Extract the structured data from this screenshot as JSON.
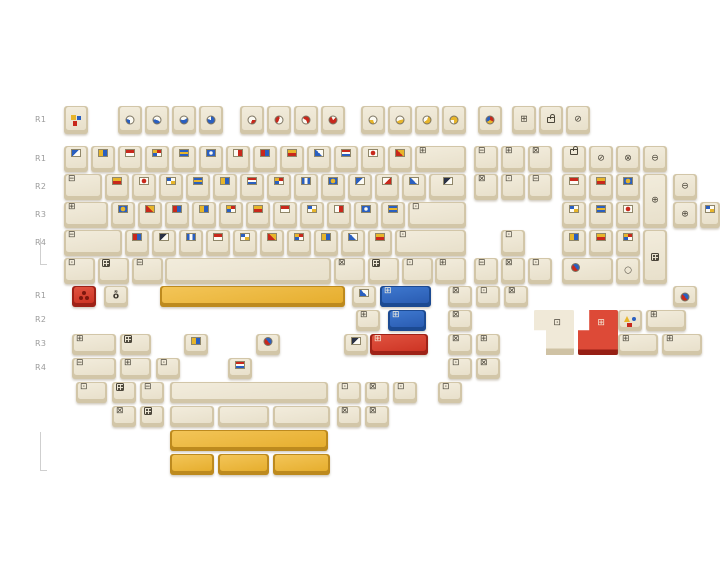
{
  "image": {
    "kind": "keycap-set-product-render",
    "background": "#ffffff"
  },
  "palette": {
    "cap_cream_top": "#ece5d3",
    "cap_cream_side": "#d2c6a8",
    "cap_yellow_top": "#eeba43",
    "cap_yellow_side": "#bd8a1e",
    "cap_red_top": "#d93b2a",
    "cap_red_side": "#9e2217",
    "cap_blue_top": "#2f6cc3",
    "cap_blue_side": "#1c4a92",
    "legend_red": "#c8281c",
    "legend_blue": "#2a5fc0",
    "legend_yellow": "#e7b52b",
    "legend_outline": "#4a4539",
    "label_gray": "#9c9c9c"
  },
  "row_labels": [
    {
      "t": "R1",
      "x": 35,
      "y": 115
    },
    {
      "t": "R1",
      "x": 35,
      "y": 154
    },
    {
      "t": "R2",
      "x": 35,
      "y": 182
    },
    {
      "t": "R3",
      "x": 35,
      "y": 210
    },
    {
      "t": "R4",
      "x": 35,
      "y": 238
    },
    {
      "t": "R1",
      "x": 35,
      "y": 291
    },
    {
      "t": "R2",
      "x": 35,
      "y": 315
    },
    {
      "t": "R3",
      "x": 35,
      "y": 339
    },
    {
      "t": "R4",
      "x": 35,
      "y": 363
    }
  ],
  "brackets": [
    {
      "x": 40,
      "y": 238,
      "w": 6,
      "h": 26
    },
    {
      "x": 40,
      "y": 432,
      "w": 6,
      "h": 38
    }
  ],
  "keys": [
    {
      "n": "key-esc",
      "x": 64,
      "y": 106,
      "t": "esc",
      "p": "c"
    },
    {
      "n": "key-f1",
      "x": 118,
      "y": 106,
      "t": "pie",
      "v": "b30-180",
      "p": "c"
    },
    {
      "n": "key-f2",
      "x": 145,
      "y": 106,
      "t": "pie",
      "v": "b45-120",
      "p": "c"
    },
    {
      "n": "key-f3",
      "x": 172,
      "y": 106,
      "t": "pie",
      "v": "b60-60",
      "p": "c"
    },
    {
      "n": "key-f4",
      "x": 199,
      "y": 106,
      "t": "pie",
      "v": "b80-0",
      "p": "c"
    },
    {
      "n": "key-f5",
      "x": 240,
      "y": 106,
      "t": "pie",
      "v": "r30-90",
      "p": "c"
    },
    {
      "n": "key-f6",
      "x": 267,
      "y": 106,
      "t": "pie",
      "v": "r45-210",
      "p": "c"
    },
    {
      "n": "key-f7",
      "x": 294,
      "y": 106,
      "t": "pie",
      "v": "r60-300",
      "p": "c"
    },
    {
      "n": "key-f8",
      "x": 321,
      "y": 106,
      "t": "pie",
      "v": "r80-45",
      "p": "c"
    },
    {
      "n": "key-f9",
      "x": 361,
      "y": 106,
      "t": "pie",
      "v": "y30-160",
      "p": "c"
    },
    {
      "n": "key-f10",
      "x": 388,
      "y": 106,
      "t": "pie",
      "v": "y45-80",
      "p": "c"
    },
    {
      "n": "key-f11",
      "x": 415,
      "y": 106,
      "t": "pie",
      "v": "y60-20",
      "p": "c"
    },
    {
      "n": "key-f12",
      "x": 442,
      "y": 106,
      "t": "pie",
      "v": "y75-270",
      "p": "c"
    },
    {
      "n": "key-novelty-pie",
      "x": 478,
      "y": 106,
      "t": "pie",
      "v": "m",
      "p": "c"
    },
    {
      "n": "key-printscreen",
      "x": 512,
      "y": 106,
      "t": "box",
      "v": "⊞",
      "p": "c"
    },
    {
      "n": "key-scrolllock",
      "x": 539,
      "y": 106,
      "t": "lock",
      "p": "c"
    },
    {
      "n": "key-pause",
      "x": 566,
      "y": 106,
      "t": "box",
      "v": "⊘",
      "p": "c"
    },
    {
      "n": "key-r1-1",
      "x": 64,
      "y": 146,
      "t": "flag",
      "v": "f1"
    },
    {
      "n": "key-r1-2",
      "x": 91,
      "y": 146,
      "t": "flag",
      "v": "f2"
    },
    {
      "n": "key-r1-3",
      "x": 118,
      "y": 146,
      "t": "flag",
      "v": "f3"
    },
    {
      "n": "key-r1-4",
      "x": 145,
      "y": 146,
      "t": "flag",
      "v": "f6"
    },
    {
      "n": "key-r1-5",
      "x": 172,
      "y": 146,
      "t": "flag",
      "v": "f5"
    },
    {
      "n": "key-r1-6",
      "x": 199,
      "y": 146,
      "t": "flag",
      "v": "f9"
    },
    {
      "n": "key-r1-7",
      "x": 226,
      "y": 146,
      "t": "flag",
      "v": "f7"
    },
    {
      "n": "key-r1-8",
      "x": 253,
      "y": 146,
      "t": "flag",
      "v": "f14"
    },
    {
      "n": "key-r1-9",
      "x": 280,
      "y": 146,
      "t": "flag",
      "v": "f8"
    },
    {
      "n": "key-r1-10",
      "x": 307,
      "y": 146,
      "t": "flag",
      "v": "f13"
    },
    {
      "n": "key-r1-11",
      "x": 334,
      "y": 146,
      "t": "flag",
      "v": "f10"
    },
    {
      "n": "key-r1-12",
      "x": 361,
      "y": 146,
      "t": "flag",
      "v": "f4"
    },
    {
      "n": "key-r1-13",
      "x": 388,
      "y": 146,
      "t": "flag",
      "v": "f11"
    },
    {
      "n": "key-backspace",
      "x": 415,
      "y": 146,
      "w": 51,
      "t": "box",
      "v": "⊞"
    },
    {
      "n": "key-tab",
      "x": 64,
      "y": 174,
      "w": 38,
      "t": "box",
      "v": "⊟"
    },
    {
      "n": "key-r2-1",
      "x": 105,
      "y": 174,
      "t": "flag",
      "v": "f8"
    },
    {
      "n": "key-r2-2",
      "x": 132,
      "y": 174,
      "t": "flag",
      "v": "f4"
    },
    {
      "n": "key-r2-3",
      "x": 159,
      "y": 174,
      "t": "flag",
      "v": "f16"
    },
    {
      "n": "key-r2-4",
      "x": 186,
      "y": 174,
      "t": "flag",
      "v": "f5"
    },
    {
      "n": "key-r2-5",
      "x": 213,
      "y": 174,
      "t": "flag",
      "v": "f2"
    },
    {
      "n": "key-r2-6",
      "x": 240,
      "y": 174,
      "t": "flag",
      "v": "f10"
    },
    {
      "n": "key-r2-7",
      "x": 267,
      "y": 174,
      "t": "flag",
      "v": "f6"
    },
    {
      "n": "key-r2-8",
      "x": 294,
      "y": 174,
      "t": "flag",
      "v": "f12"
    },
    {
      "n": "key-r2-9",
      "x": 321,
      "y": 174,
      "t": "flag",
      "v": "f17"
    },
    {
      "n": "key-r2-10",
      "x": 348,
      "y": 174,
      "t": "flag",
      "v": "f1"
    },
    {
      "n": "key-r2-11",
      "x": 375,
      "y": 174,
      "t": "flag",
      "v": "f15"
    },
    {
      "n": "key-r2-12",
      "x": 402,
      "y": 174,
      "t": "flag",
      "v": "f13"
    },
    {
      "n": "key-backslash",
      "x": 429,
      "y": 174,
      "w": 37,
      "t": "flag",
      "v": "f18"
    },
    {
      "n": "key-capslock",
      "x": 64,
      "y": 202,
      "w": 44,
      "t": "box",
      "v": "⊞"
    },
    {
      "n": "key-r3-1",
      "x": 111,
      "y": 202,
      "t": "flag",
      "v": "f17"
    },
    {
      "n": "key-r3-2",
      "x": 138,
      "y": 202,
      "t": "flag",
      "v": "f11"
    },
    {
      "n": "key-r3-3",
      "x": 165,
      "y": 202,
      "t": "flag",
      "v": "f14"
    },
    {
      "n": "key-r3-4",
      "x": 192,
      "y": 202,
      "t": "flag",
      "v": "f2"
    },
    {
      "n": "key-r3-5",
      "x": 219,
      "y": 202,
      "t": "flag",
      "v": "f6"
    },
    {
      "n": "key-r3-6",
      "x": 246,
      "y": 202,
      "t": "flag",
      "v": "f8"
    },
    {
      "n": "key-r3-7",
      "x": 273,
      "y": 202,
      "t": "flag",
      "v": "f3"
    },
    {
      "n": "key-r3-8",
      "x": 300,
      "y": 202,
      "t": "flag",
      "v": "f16"
    },
    {
      "n": "key-r3-9",
      "x": 327,
      "y": 202,
      "t": "flag",
      "v": "f7"
    },
    {
      "n": "key-r3-10",
      "x": 354,
      "y": 202,
      "t": "flag",
      "v": "f9"
    },
    {
      "n": "key-r3-11",
      "x": 381,
      "y": 202,
      "t": "flag",
      "v": "f5"
    },
    {
      "n": "key-enter",
      "x": 408,
      "y": 202,
      "w": 58,
      "t": "box",
      "v": "⊡"
    },
    {
      "n": "key-lshift",
      "x": 64,
      "y": 230,
      "w": 58,
      "t": "box",
      "v": "⊟"
    },
    {
      "n": "key-r4-1",
      "x": 125,
      "y": 230,
      "t": "flag",
      "v": "f14"
    },
    {
      "n": "key-r4-2",
      "x": 152,
      "y": 230,
      "t": "flag",
      "v": "f18"
    },
    {
      "n": "key-r4-3",
      "x": 179,
      "y": 230,
      "t": "flag",
      "v": "f12"
    },
    {
      "n": "key-r4-4",
      "x": 206,
      "y": 230,
      "t": "flag",
      "v": "f3"
    },
    {
      "n": "key-r4-5",
      "x": 233,
      "y": 230,
      "t": "flag",
      "v": "f16"
    },
    {
      "n": "key-r4-6",
      "x": 260,
      "y": 230,
      "t": "flag",
      "v": "f11"
    },
    {
      "n": "key-r4-7",
      "x": 287,
      "y": 230,
      "t": "flag",
      "v": "f6"
    },
    {
      "n": "key-r4-8",
      "x": 314,
      "y": 230,
      "t": "flag",
      "v": "f2"
    },
    {
      "n": "key-r4-9",
      "x": 341,
      "y": 230,
      "t": "flag",
      "v": "f13"
    },
    {
      "n": "key-r4-10",
      "x": 368,
      "y": 230,
      "t": "flag",
      "v": "f8"
    },
    {
      "n": "key-rshift",
      "x": 395,
      "y": 230,
      "w": 71,
      "t": "box",
      "v": "⊡"
    },
    {
      "n": "key-lctrl",
      "x": 64,
      "y": 258,
      "w": 31,
      "t": "box",
      "v": "⊡"
    },
    {
      "n": "key-lwin",
      "x": 98,
      "y": 258,
      "w": 31,
      "t": "dice"
    },
    {
      "n": "key-lalt",
      "x": 132,
      "y": 258,
      "w": 31,
      "t": "box",
      "v": "⊟"
    },
    {
      "n": "key-space",
      "x": 165,
      "y": 258,
      "w": 166,
      "t": "blank"
    },
    {
      "n": "key-ralt",
      "x": 334,
      "y": 258,
      "w": 31,
      "t": "box",
      "v": "⊠"
    },
    {
      "n": "key-fn",
      "x": 368,
      "y": 258,
      "w": 31,
      "t": "dice"
    },
    {
      "n": "key-menu",
      "x": 402,
      "y": 258,
      "w": 31,
      "t": "box",
      "v": "⊡"
    },
    {
      "n": "key-rctrl",
      "x": 435,
      "y": 258,
      "w": 31,
      "t": "box",
      "v": "⊞"
    },
    {
      "n": "key-insert",
      "x": 474,
      "y": 146,
      "t": "box",
      "v": "⊟"
    },
    {
      "n": "key-home",
      "x": 501,
      "y": 146,
      "t": "box",
      "v": "⊞"
    },
    {
      "n": "key-pageup",
      "x": 528,
      "y": 146,
      "t": "box",
      "v": "⊠"
    },
    {
      "n": "key-delete",
      "x": 474,
      "y": 174,
      "t": "box",
      "v": "⊠"
    },
    {
      "n": "key-end",
      "x": 501,
      "y": 174,
      "t": "box",
      "v": "⊡"
    },
    {
      "n": "key-pagedown",
      "x": 528,
      "y": 174,
      "t": "box",
      "v": "⊟"
    },
    {
      "n": "key-arrow-up",
      "x": 501,
      "y": 230,
      "t": "box",
      "v": "⊡"
    },
    {
      "n": "key-arrow-left",
      "x": 474,
      "y": 258,
      "t": "box",
      "v": "⊟"
    },
    {
      "n": "key-arrow-down",
      "x": 501,
      "y": 258,
      "t": "box",
      "v": "⊠"
    },
    {
      "n": "key-arrow-right",
      "x": 528,
      "y": 258,
      "t": "box",
      "v": "⊡"
    },
    {
      "n": "key-numlock",
      "x": 562,
      "y": 146,
      "t": "lock"
    },
    {
      "n": "key-num-divide",
      "x": 589,
      "y": 146,
      "t": "box",
      "v": "⊘",
      "p": "c"
    },
    {
      "n": "key-num-multiply",
      "x": 616,
      "y": 146,
      "t": "box",
      "v": "⊗",
      "p": "c"
    },
    {
      "n": "key-num-minus",
      "x": 643,
      "y": 146,
      "t": "box",
      "v": "⊖",
      "p": "c"
    },
    {
      "n": "key-num-7",
      "x": 562,
      "y": 174,
      "t": "flag",
      "v": "f3"
    },
    {
      "n": "key-num-8",
      "x": 589,
      "y": 174,
      "t": "flag",
      "v": "f8"
    },
    {
      "n": "key-num-9",
      "x": 616,
      "y": 174,
      "t": "flag",
      "v": "f17"
    },
    {
      "n": "key-num-plus",
      "x": 643,
      "y": 174,
      "h": 54,
      "t": "box",
      "v": "⊕",
      "p": "c"
    },
    {
      "n": "key-num-4",
      "x": 562,
      "y": 202,
      "t": "flag",
      "v": "f16"
    },
    {
      "n": "key-num-5",
      "x": 589,
      "y": 202,
      "t": "flag",
      "v": "f5"
    },
    {
      "n": "key-num-6",
      "x": 616,
      "y": 202,
      "t": "flag",
      "v": "f4"
    },
    {
      "n": "key-num-1",
      "x": 562,
      "y": 230,
      "t": "flag",
      "v": "f2"
    },
    {
      "n": "key-num-2",
      "x": 589,
      "y": 230,
      "t": "flag",
      "v": "f8"
    },
    {
      "n": "key-num-3",
      "x": 616,
      "y": 230,
      "t": "flag",
      "v": "f6"
    },
    {
      "n": "key-num-enter",
      "x": 643,
      "y": 230,
      "h": 54,
      "t": "dice",
      "p": "c"
    },
    {
      "n": "key-num-0",
      "x": 562,
      "y": 258,
      "w": 51,
      "t": "pie",
      "v": "rb",
      "p": "l"
    },
    {
      "n": "key-num-dot",
      "x": 616,
      "y": 258,
      "t": "box",
      "v": "○",
      "p": "c"
    },
    {
      "n": "key-extra-minus",
      "x": 673,
      "y": 174,
      "t": "box",
      "v": "⊖",
      "p": "c"
    },
    {
      "n": "key-extra-plus",
      "x": 673,
      "y": 202,
      "t": "box",
      "v": "⊕",
      "p": "c"
    },
    {
      "n": "key-extra-flag",
      "x": 700,
      "y": 202,
      "w": 20,
      "t": "flag",
      "v": "f16"
    },
    {
      "n": "key-extra-pie",
      "x": 673,
      "y": 286,
      "t": "pie",
      "v": "rb",
      "p": "c"
    },
    {
      "n": "key-esc-red-novelty",
      "x": 72,
      "y": 286,
      "c": "red",
      "t": "trefoil",
      "p": "c"
    },
    {
      "n": "key-script-novelty",
      "x": 104,
      "y": 286,
      "t": "txt",
      "v": "ȭ",
      "p": "c"
    },
    {
      "n": "key-spacebar-yellow-625u",
      "x": 160,
      "y": 286,
      "w": 185,
      "c": "yellow",
      "t": "blank"
    },
    {
      "n": "key-b1-flag",
      "x": 352,
      "y": 286,
      "t": "flag",
      "v": "f13"
    },
    {
      "n": "key-blue-backspace-2u",
      "x": 380,
      "y": 286,
      "w": 51,
      "c": "blue",
      "t": "box",
      "v": "⊞"
    },
    {
      "n": "key-b1-mod1",
      "x": 448,
      "y": 286,
      "t": "box",
      "v": "⊠"
    },
    {
      "n": "key-b1-mod2",
      "x": 476,
      "y": 286,
      "t": "box",
      "v": "⊡"
    },
    {
      "n": "key-b1-mod3",
      "x": 504,
      "y": 286,
      "t": "box",
      "v": "⊠"
    },
    {
      "n": "key-b2-mod1",
      "x": 356,
      "y": 310,
      "t": "box",
      "v": "⊞"
    },
    {
      "n": "key-blue-tab-15u",
      "x": 388,
      "y": 310,
      "w": 38,
      "c": "blue",
      "t": "box",
      "v": "⊞"
    },
    {
      "n": "key-b2-mod2",
      "x": 448,
      "y": 310,
      "t": "box",
      "v": "⊠"
    },
    {
      "n": "key-iso-enter-cream",
      "x": 534,
      "y": 310,
      "w": 40,
      "h": 45,
      "t": "iso-l"
    },
    {
      "n": "key-iso-enter-red",
      "x": 578,
      "y": 310,
      "w": 40,
      "h": 45,
      "c": "red",
      "t": "iso-r"
    },
    {
      "n": "key-shapes-novelty",
      "x": 618,
      "y": 310,
      "t": "shapes",
      "p": "c"
    },
    {
      "n": "key-b2-wide1",
      "x": 646,
      "y": 310,
      "w": 40,
      "t": "box",
      "v": "⊞"
    },
    {
      "n": "key-b3-175u",
      "x": 72,
      "y": 334,
      "w": 44,
      "t": "box",
      "v": "⊞"
    },
    {
      "n": "key-b3-125u",
      "x": 120,
      "y": 334,
      "w": 31,
      "t": "dice"
    },
    {
      "n": "key-b3-flag1",
      "x": 184,
      "y": 334,
      "t": "flag",
      "v": "f2"
    },
    {
      "n": "key-b3-pie",
      "x": 256,
      "y": 334,
      "t": "pie",
      "v": "rb"
    },
    {
      "n": "key-b3-flag2",
      "x": 344,
      "y": 334,
      "t": "flag",
      "v": "f18"
    },
    {
      "n": "key-red-enter-225u",
      "x": 370,
      "y": 334,
      "w": 58,
      "c": "red",
      "t": "box",
      "v": "⊞"
    },
    {
      "n": "key-b3-mod1",
      "x": 448,
      "y": 334,
      "t": "box",
      "v": "⊠"
    },
    {
      "n": "key-b3-mod2",
      "x": 476,
      "y": 334,
      "t": "box",
      "v": "⊞"
    },
    {
      "n": "key-b3-wide1",
      "x": 618,
      "y": 334,
      "w": 40,
      "t": "box",
      "v": "⊞"
    },
    {
      "n": "key-b3-wide2",
      "x": 662,
      "y": 334,
      "w": 40,
      "t": "box",
      "v": "⊞"
    },
    {
      "n": "key-b4-175u",
      "x": 72,
      "y": 358,
      "w": 44,
      "t": "box",
      "v": "⊟"
    },
    {
      "n": "key-b4-125u",
      "x": 120,
      "y": 358,
      "w": 31,
      "t": "box",
      "v": "⊞"
    },
    {
      "n": "key-b4-1u",
      "x": 156,
      "y": 358,
      "t": "box",
      "v": "⊡"
    },
    {
      "n": "key-b4-flag",
      "x": 228,
      "y": 358,
      "t": "flag",
      "v": "f10"
    },
    {
      "n": "key-b4-mod1",
      "x": 448,
      "y": 358,
      "t": "box",
      "v": "⊡"
    },
    {
      "n": "key-b4-mod2",
      "x": 476,
      "y": 358,
      "t": "box",
      "v": "⊠"
    },
    {
      "n": "key-b5-125u",
      "x": 76,
      "y": 382,
      "w": 31,
      "t": "box",
      "v": "⊡"
    },
    {
      "n": "key-b5-dice",
      "x": 112,
      "y": 382,
      "t": "dice"
    },
    {
      "n": "key-b5-1u",
      "x": 140,
      "y": 382,
      "t": "box",
      "v": "⊟"
    },
    {
      "n": "key-long-blank-bar",
      "x": 170,
      "y": 382,
      "w": 158,
      "t": "blank"
    },
    {
      "n": "key-b5-mod1",
      "x": 337,
      "y": 382,
      "t": "box",
      "v": "⊡"
    },
    {
      "n": "key-b5-mod2",
      "x": 365,
      "y": 382,
      "t": "box",
      "v": "⊠"
    },
    {
      "n": "key-b5-mod3",
      "x": 393,
      "y": 382,
      "t": "box",
      "v": "⊡"
    },
    {
      "n": "key-b5-mod4",
      "x": 438,
      "y": 382,
      "t": "box",
      "v": "⊡"
    },
    {
      "n": "key-b6-1u-a",
      "x": 112,
      "y": 406,
      "t": "box",
      "v": "⊠"
    },
    {
      "n": "key-b6-dice",
      "x": 140,
      "y": 406,
      "t": "dice"
    },
    {
      "n": "key-blank-bar-175u",
      "x": 170,
      "y": 406,
      "w": 44,
      "t": "blank"
    },
    {
      "n": "key-blank-bar-2u",
      "x": 218,
      "y": 406,
      "w": 51,
      "t": "blank"
    },
    {
      "n": "key-blank-bar-225u",
      "x": 273,
      "y": 406,
      "w": 57,
      "t": "blank"
    },
    {
      "n": "key-b6-mod1",
      "x": 337,
      "y": 406,
      "t": "box",
      "v": "⊠"
    },
    {
      "n": "key-b6-mod2",
      "x": 365,
      "y": 406,
      "t": "box",
      "v": "⊠"
    },
    {
      "n": "key-spacebar-yellow-long",
      "x": 170,
      "y": 430,
      "w": 158,
      "c": "yellow",
      "t": "blank"
    },
    {
      "n": "key-yellow-bar-175u",
      "x": 170,
      "y": 454,
      "w": 44,
      "c": "yellow",
      "t": "blank"
    },
    {
      "n": "key-yellow-bar-2u",
      "x": 218,
      "y": 454,
      "w": 51,
      "c": "yellow",
      "t": "blank"
    },
    {
      "n": "key-yellow-bar-225u",
      "x": 273,
      "y": 454,
      "w": 57,
      "c": "yellow",
      "t": "blank"
    }
  ]
}
